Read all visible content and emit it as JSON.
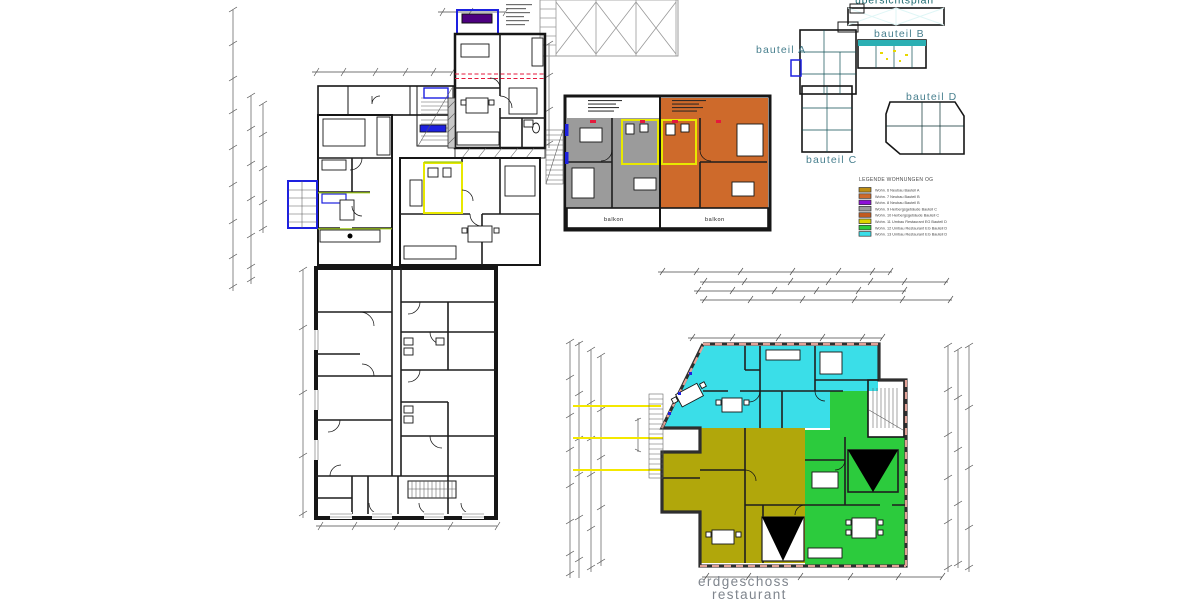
{
  "sheet": {
    "keyplan": {
      "title": "übersichtsplan",
      "labels": {
        "a": "bauteil A",
        "b": "bauteil B",
        "c": "bauteil C",
        "d": "bauteil D"
      }
    },
    "legend": {
      "title": "LEGENDE WOHNUNGEN OG",
      "items": [
        {
          "color": "#BE8D12",
          "label": "Wohn. 6 Neubau Bauteil A"
        },
        {
          "color": "#CE6A2B",
          "label": "Wohn. 7 Neubau Bauteil B"
        },
        {
          "color": "#8E10D8",
          "label": "Wohn. 8 Neubau Bauteil B"
        },
        {
          "color": "#9B9B9B",
          "label": "Wohn. 9 Herbergsgebäude Bauteil C"
        },
        {
          "color": "#C25B20",
          "label": "Wohn. 10 Herbergsgebäude Bauteil C"
        },
        {
          "color": "#DCD400",
          "label": "Wohn. 11 Umbau Restaurant EG Bauteil D"
        },
        {
          "color": "#2CCB3D",
          "label": "Wohn. 12 Umbau Restaurant EG Bauteil D"
        },
        {
          "color": "#3ADEE8",
          "label": "Wohn. 13 Umbau Restaurant EG Bauteil D"
        }
      ]
    },
    "upper_plan": {
      "balkon_left": "balkon",
      "balkon_right": "balkon"
    },
    "ground_plan": {
      "label_line1": "erdgeschoss",
      "label_line2": "restaurant"
    },
    "colors": {
      "purple": "#8E10D8",
      "orange": "#CE6A2B",
      "gold": "#D7A827",
      "gray": "#9B9B9B",
      "graydark": "#8F8F8F",
      "cyan": "#3ADEE8",
      "green": "#2CCB3D",
      "khaki": "#B1A70B",
      "teal": "#2BAFB3",
      "lightcyan": "#92F0F3",
      "darkteal": "#1F6B71"
    }
  }
}
